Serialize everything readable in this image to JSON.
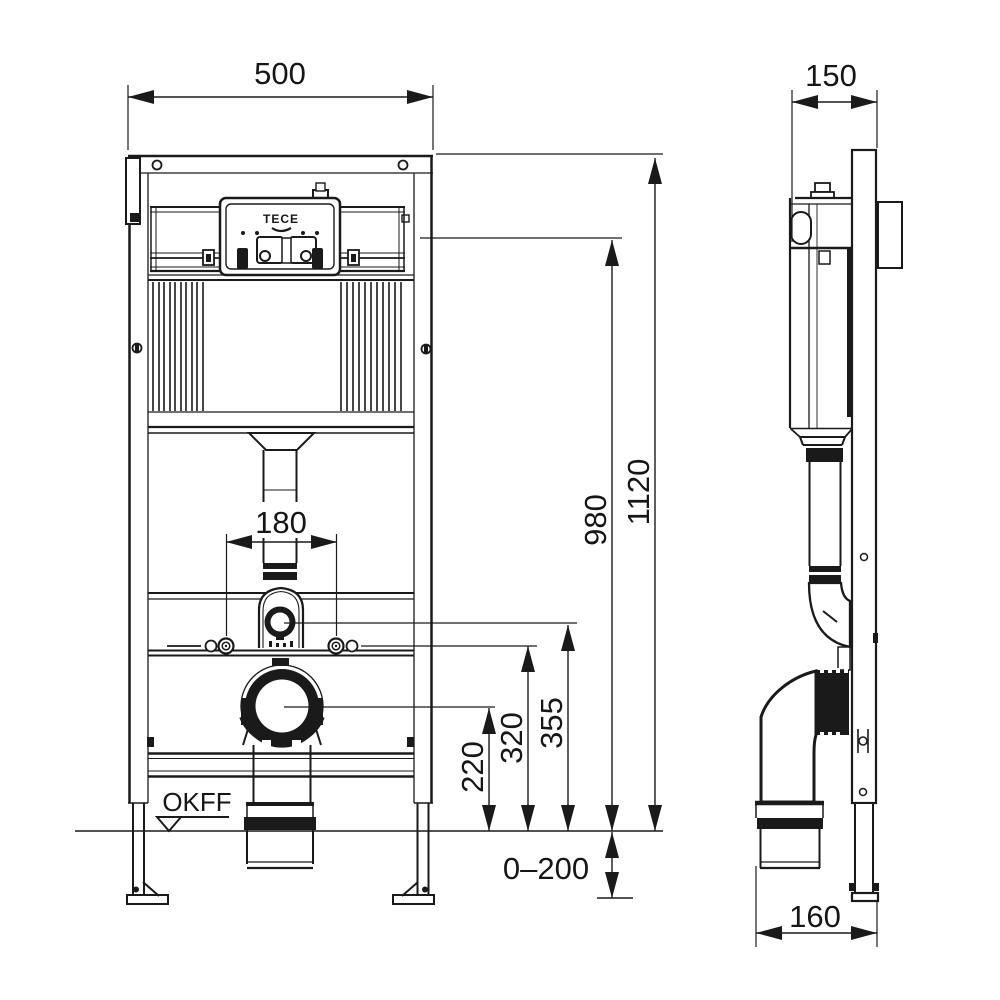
{
  "drawing": {
    "brand_label": "TECE",
    "floor_label": "OKFF",
    "dims": {
      "front_width": "500",
      "frame_depth": "150",
      "total_height": "1120",
      "cistern_top_height": "980",
      "bolt_spacing": "180",
      "flush_pipe_center_height": "355",
      "mounting_bolt_height": "320",
      "drain_center_height": "220",
      "floor_buildup": "0–200",
      "outlet_offset": "160"
    }
  }
}
